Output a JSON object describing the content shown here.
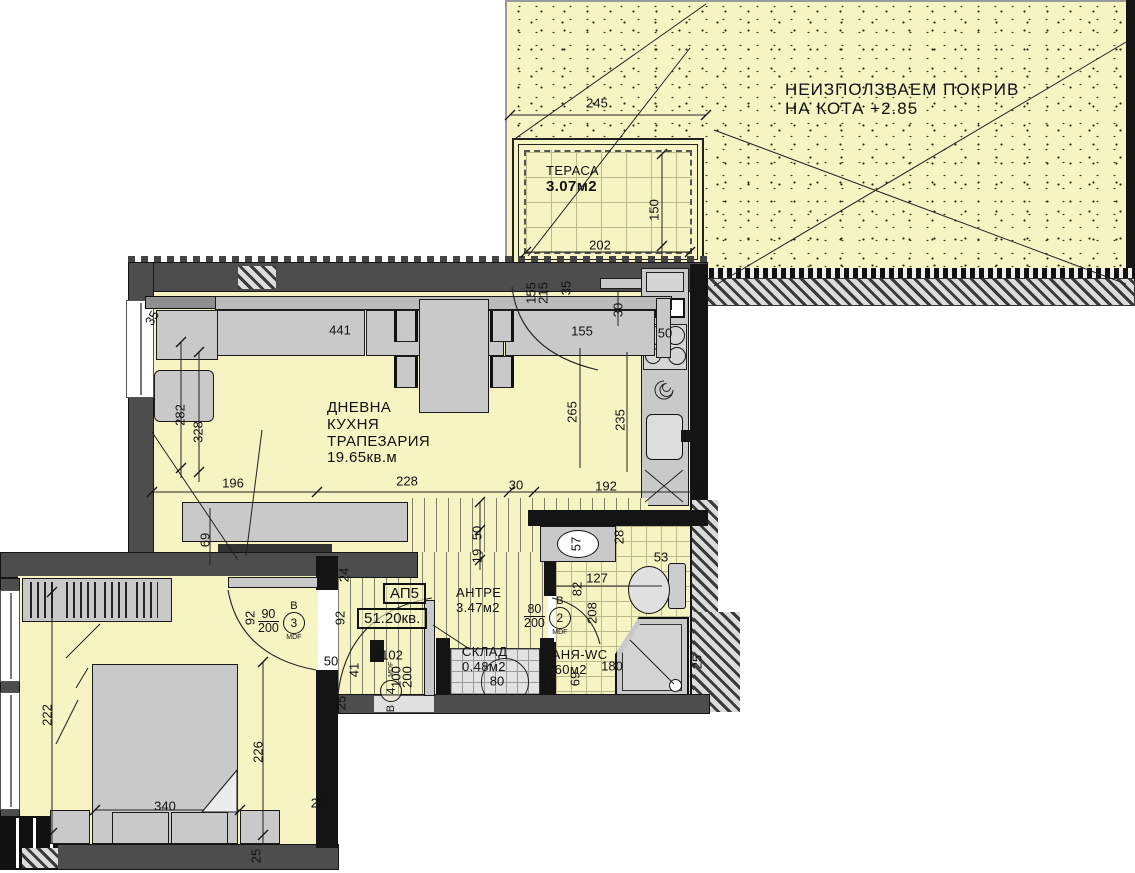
{
  "colors": {
    "floor_yellow": "#f6f4c2",
    "wall_dark": "#4d4d4d",
    "wall_black": "#141414",
    "furniture_gray": "#c9c9c9",
    "line": "#1a1a1a"
  },
  "rooms": {
    "roof": {
      "line1": "НЕИЗПОЛЗВАЕМ ПОКРИВ",
      "line2": "НА КОТА +2.85"
    },
    "terrace": {
      "name": "ТЕРАСА",
      "area": "3.07м2"
    },
    "living": {
      "line1": "ДНЕВНА",
      "line2": "КУХНЯ",
      "line3": "ТРАПЕЗАРИЯ",
      "area": "19.65кв.м"
    },
    "hall": {
      "name": "АНТРЕ",
      "area": "3.47м2"
    },
    "storage": {
      "name": "СКЛАД",
      "area": "0.48м2"
    },
    "bath": {
      "name": "БАНЯ-WC",
      "area": "3.60м2"
    },
    "apartment": {
      "id": "АП5",
      "total_area": "51.20кв."
    }
  },
  "doors": {
    "d2": {
      "letter": "В",
      "num": "2",
      "size_top": "80",
      "size_bottom": "200",
      "mat": "MDF"
    },
    "d3": {
      "letter": "В",
      "num": "3",
      "size_top": "90",
      "size_bottom": "200",
      "mat": "MDF"
    },
    "d4": {
      "letter": "В",
      "num": "4",
      "mat": "MDF"
    },
    "terrace_door_size_a": "155",
    "terrace_door_size_b": "215"
  },
  "dimensions": [
    {
      "t": "245",
      "x": 597,
      "y": 103,
      "r": 0
    },
    {
      "t": "202",
      "x": 600,
      "y": 245,
      "r": 0
    },
    {
      "t": "150",
      "x": 654,
      "y": 210,
      "r": -90
    },
    {
      "t": "441",
      "x": 340,
      "y": 330,
      "r": 0
    },
    {
      "t": "35",
      "x": 152,
      "y": 318,
      "r": -60
    },
    {
      "t": "282",
      "x": 180,
      "y": 415,
      "r": -90
    },
    {
      "t": "328",
      "x": 198,
      "y": 432,
      "r": -90
    },
    {
      "t": "155",
      "x": 531,
      "y": 293,
      "r": -90
    },
    {
      "t": "215",
      "x": 543,
      "y": 293,
      "r": -90
    },
    {
      "t": "35",
      "x": 566,
      "y": 288,
      "r": -90
    },
    {
      "t": "30",
      "x": 618,
      "y": 310,
      "r": -90
    },
    {
      "t": "155",
      "x": 582,
      "y": 331,
      "r": 0
    },
    {
      "t": "265",
      "x": 572,
      "y": 412,
      "r": -90
    },
    {
      "t": "235",
      "x": 620,
      "y": 420,
      "r": -90
    },
    {
      "t": "50",
      "x": 665,
      "y": 333,
      "r": 0
    },
    {
      "t": "196",
      "x": 233,
      "y": 483,
      "r": 0
    },
    {
      "t": "228",
      "x": 407,
      "y": 481,
      "r": 0
    },
    {
      "t": "30",
      "x": 516,
      "y": 485,
      "r": 0
    },
    {
      "t": "192",
      "x": 606,
      "y": 486,
      "r": 0
    },
    {
      "t": "69",
      "x": 205,
      "y": 540,
      "r": -90
    },
    {
      "t": "24",
      "x": 344,
      "y": 575,
      "r": -90
    },
    {
      "t": "50",
      "x": 477,
      "y": 533,
      "r": -90
    },
    {
      "t": "19",
      "x": 477,
      "y": 556,
      "r": -90
    },
    {
      "t": "92",
      "x": 250,
      "y": 618,
      "r": -90
    },
    {
      "t": "92",
      "x": 340,
      "y": 618,
      "r": -90
    },
    {
      "t": "102",
      "x": 392,
      "y": 655,
      "r": 0
    },
    {
      "t": "100",
      "x": 396,
      "y": 677,
      "r": -90
    },
    {
      "t": "200",
      "x": 407,
      "y": 677,
      "r": -90
    },
    {
      "t": "50",
      "x": 331,
      "y": 661,
      "r": 0
    },
    {
      "t": "41",
      "x": 354,
      "y": 670,
      "r": -90
    },
    {
      "t": "25",
      "x": 341,
      "y": 703,
      "r": -90
    },
    {
      "t": "80",
      "x": 497,
      "y": 681,
      "r": 0
    },
    {
      "t": "57",
      "x": 576,
      "y": 544,
      "r": -90
    },
    {
      "t": "28",
      "x": 619,
      "y": 537,
      "r": -90
    },
    {
      "t": "53",
      "x": 661,
      "y": 557,
      "r": 0
    },
    {
      "t": "127",
      "x": 597,
      "y": 578,
      "r": 0
    },
    {
      "t": "82",
      "x": 577,
      "y": 589,
      "r": -90
    },
    {
      "t": "208",
      "x": 592,
      "y": 613,
      "r": -90
    },
    {
      "t": "180",
      "x": 612,
      "y": 666,
      "r": 0
    },
    {
      "t": "69",
      "x": 575,
      "y": 679,
      "r": -90
    },
    {
      "t": "12",
      "x": 548,
      "y": 683,
      "r": 0
    },
    {
      "t": "25",
      "x": 697,
      "y": 662,
      "r": -90
    },
    {
      "t": "222",
      "x": 47,
      "y": 715,
      "r": -90
    },
    {
      "t": "226",
      "x": 258,
      "y": 752,
      "r": -90
    },
    {
      "t": "340",
      "x": 165,
      "y": 806,
      "r": 0
    },
    {
      "t": "51",
      "x": 45,
      "y": 830,
      "r": -90
    },
    {
      "t": "25",
      "x": 318,
      "y": 803,
      "r": 0
    },
    {
      "t": "25",
      "x": 256,
      "y": 856,
      "r": -90
    }
  ]
}
